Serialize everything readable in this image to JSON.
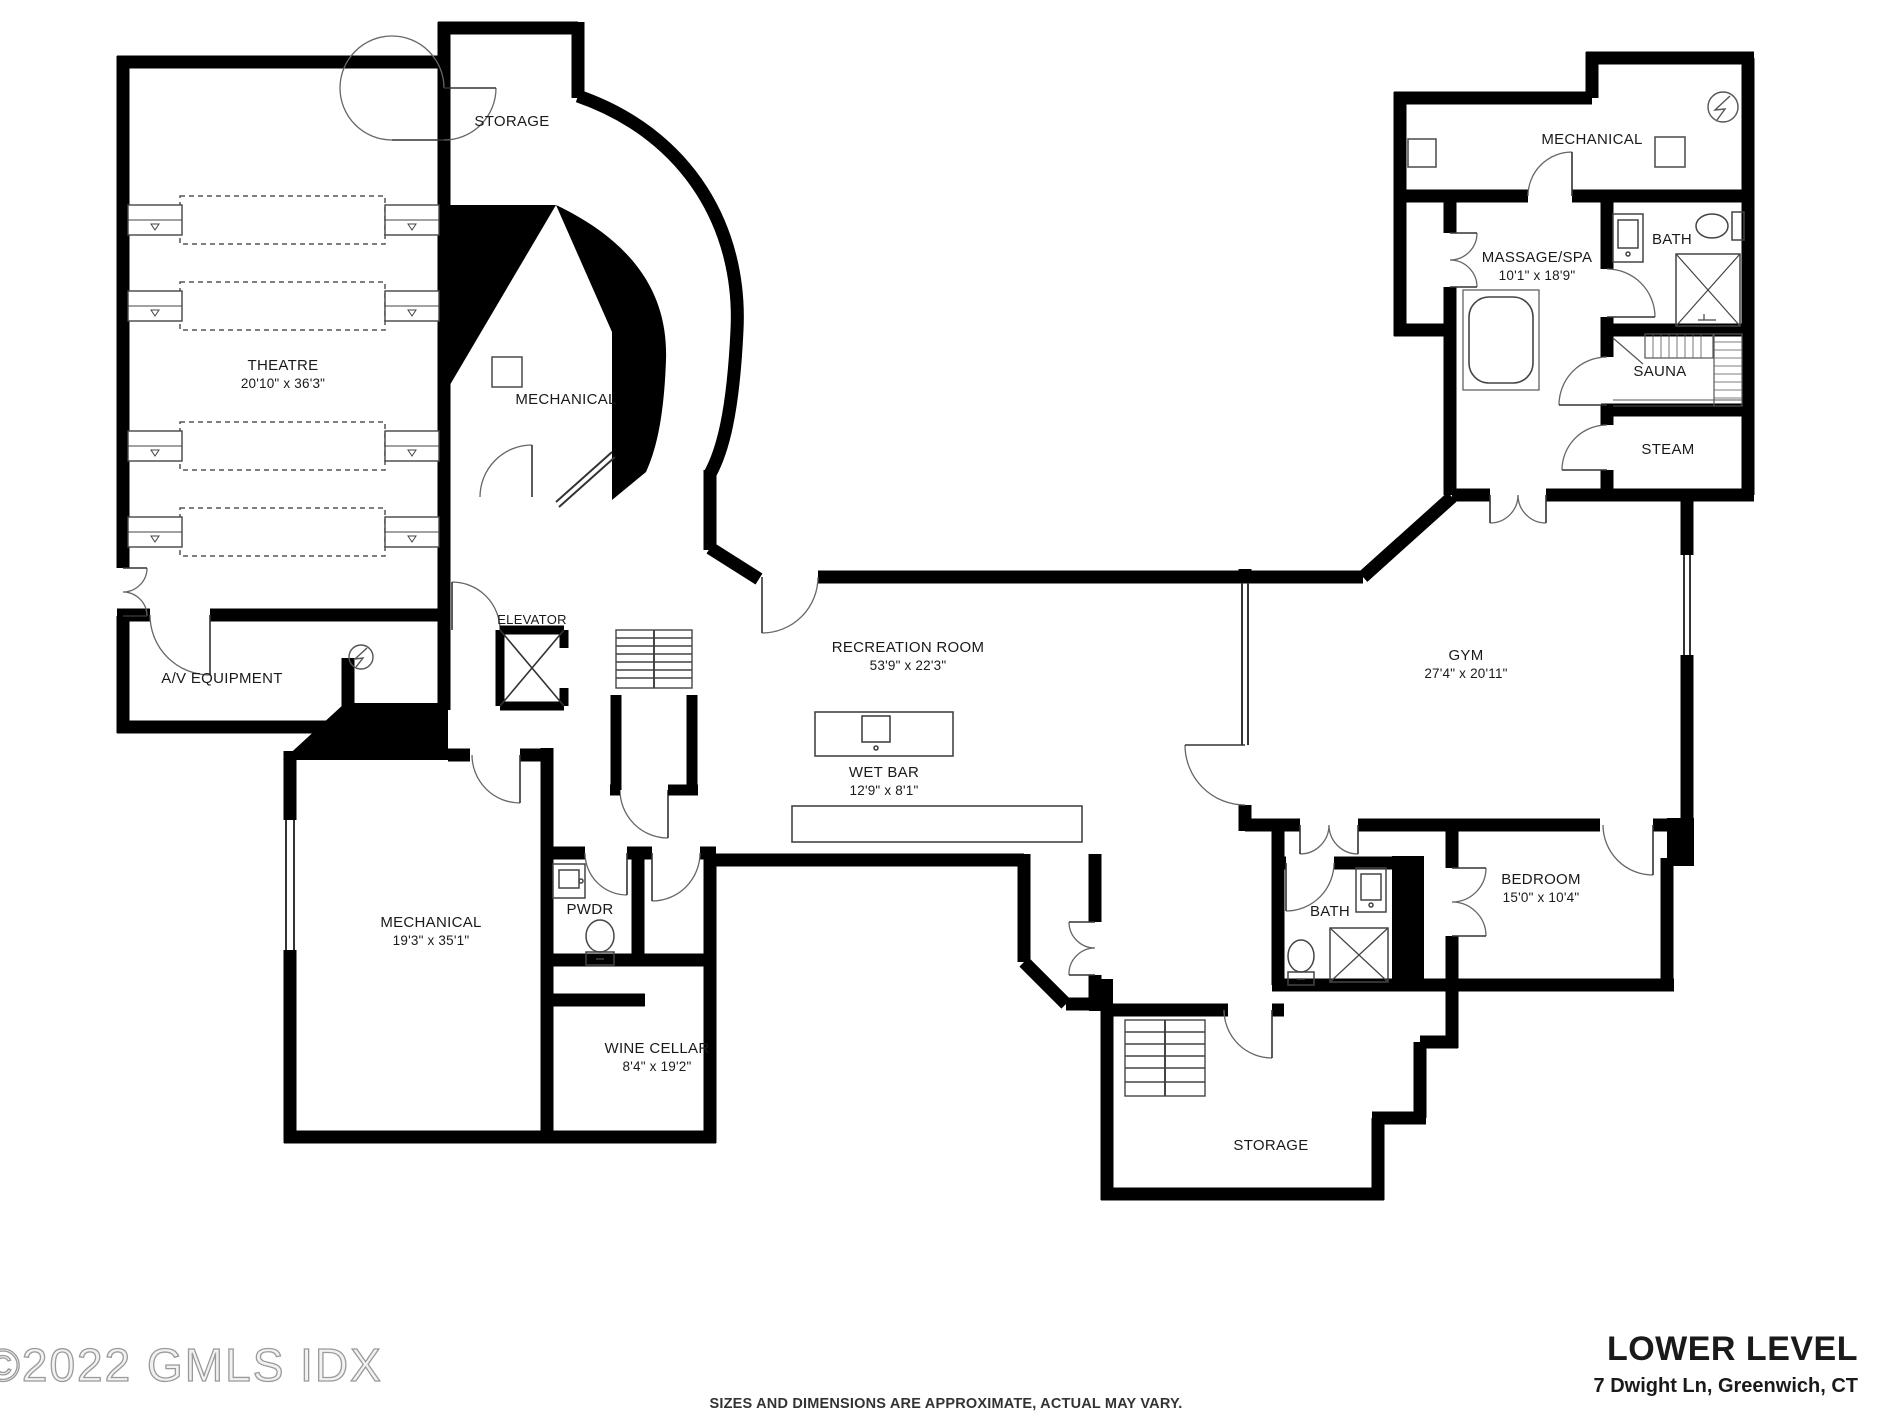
{
  "plan_name": "Lower Level Floor Plan",
  "colors": {
    "walls": "#000000",
    "background": "#ffffff",
    "watermark": "#9a9a9a",
    "text": "#1a1a1a"
  },
  "icons": {
    "electrical_panel": "circle with lightning bolt",
    "elevator": "box with X",
    "shower": "box with X",
    "stairs": "treads with center rail"
  },
  "rooms": [
    {
      "id": "theatre",
      "label": "THEATRE",
      "dims": "20'10\" x 36'3\""
    },
    {
      "id": "storage-top",
      "label": "STORAGE",
      "dims": ""
    },
    {
      "id": "mechanical-center",
      "label": "MECHANICAL",
      "dims": ""
    },
    {
      "id": "av-equipment",
      "label": "A/V EQUIPMENT",
      "dims": ""
    },
    {
      "id": "elevator",
      "label": "ELEVATOR",
      "dims": ""
    },
    {
      "id": "recreation-room",
      "label": "RECREATION ROOM",
      "dims": "53'9\" x 22'3\""
    },
    {
      "id": "wet-bar",
      "label": "WET BAR",
      "dims": "12'9\" x 8'1\""
    },
    {
      "id": "mechanical-upper",
      "label": "MECHANICAL",
      "dims": ""
    },
    {
      "id": "massage-spa",
      "label": "MASSAGE/SPA",
      "dims": "10'1\" x 18'9\""
    },
    {
      "id": "bath-upper",
      "label": "BATH",
      "dims": ""
    },
    {
      "id": "sauna",
      "label": "SAUNA",
      "dims": ""
    },
    {
      "id": "steam",
      "label": "STEAM",
      "dims": ""
    },
    {
      "id": "gym",
      "label": "GYM",
      "dims": "27'4\" x 20'11\""
    },
    {
      "id": "mechanical-lower",
      "label": "MECHANICAL",
      "dims": "19'3\" x 35'1\""
    },
    {
      "id": "pwdr",
      "label": "PWDR",
      "dims": ""
    },
    {
      "id": "wine-cellar",
      "label": "WINE CELLAR",
      "dims": "8'4\" x 19'2\""
    },
    {
      "id": "bedroom",
      "label": "BEDROOM",
      "dims": "15'0\" x 10'4\""
    },
    {
      "id": "bath-lower",
      "label": "BATH",
      "dims": ""
    },
    {
      "id": "storage-bottom",
      "label": "STORAGE",
      "dims": ""
    }
  ],
  "footer": {
    "watermark": "©2022 GMLS IDX",
    "disclaimer": "SIZES AND DIMENSIONS ARE APPROXIMATE, ACTUAL MAY VARY.",
    "title": "LOWER LEVEL",
    "address": "7 Dwight Ln, Greenwich, CT"
  }
}
